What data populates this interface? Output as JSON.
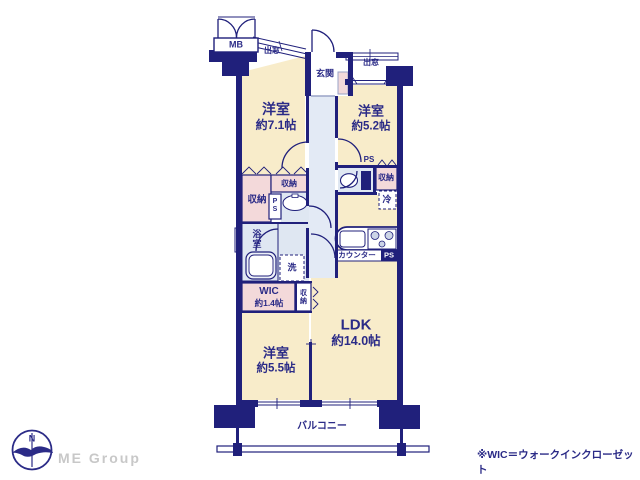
{
  "rooms": {
    "western1": {
      "name": "洋室",
      "size": "約7.1帖"
    },
    "western2": {
      "name": "洋室",
      "size": "約5.2帖"
    },
    "western3": {
      "name": "洋室",
      "size": "約5.5帖"
    },
    "ldk": {
      "name": "LDK",
      "size": "約14.0帖"
    },
    "wic": {
      "name": "WIC",
      "size": "約1.4帖"
    },
    "entrance": {
      "name": "玄関"
    },
    "bathroom": {
      "name": "浴室"
    },
    "balcony": {
      "name": "バルコニー"
    }
  },
  "features": {
    "meter_box": "MB",
    "bay_window_top_left": "出窓",
    "bay_window_top_right": "出窓",
    "closet_main": "収納",
    "closet_hall": "収納",
    "closet_west2": "収納",
    "closet_west3": "収納",
    "pipe_space_wash": "PS",
    "pipe_space_toilet": "PS",
    "pipe_space_kitchen": "PS",
    "refrigerator": "冷",
    "washer": "洗",
    "kitchen_counter": "カウンター"
  },
  "footer": {
    "compass_north": "N",
    "brand": "ME Group",
    "note": "※WIC＝ウォークインクローゼット"
  },
  "colors": {
    "wall_navy": "#20207b",
    "text_navy": "#2b2b87",
    "room_cream": "#f8ecca",
    "closet_pink": "#f3d9da",
    "wet_blue": "#dfe7f2",
    "logo_gray": "#c8c8c8"
  }
}
